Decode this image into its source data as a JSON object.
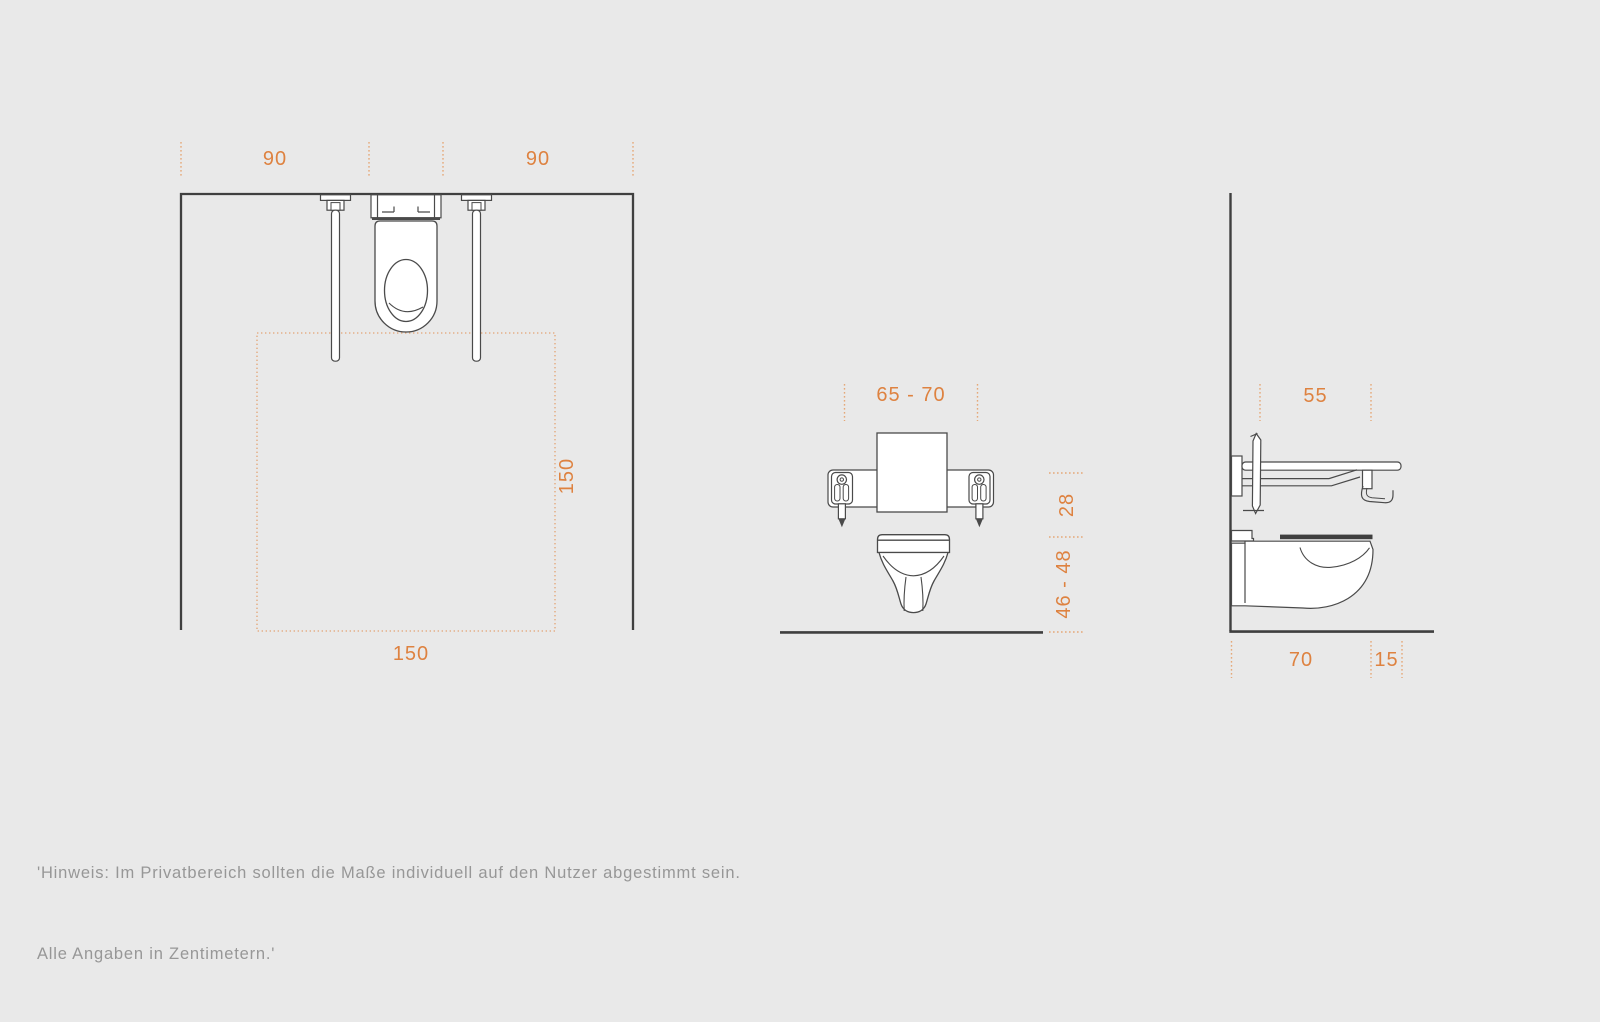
{
  "colors": {
    "background": "#e9e9e9",
    "fixture_line": "#4a4a4a",
    "wall_line": "#3f3f3f",
    "accent_orange": "#de8240",
    "tick_orange": "#e5a878",
    "note_gray": "#979797"
  },
  "views": {
    "plan": {
      "dim_left_clearance": "90",
      "dim_right_clearance": "90",
      "dim_maneuvering_depth": "150",
      "dim_maneuvering_width": "150"
    },
    "front": {
      "dim_grab_bar_span": "65 - 70",
      "dim_seat_to_bar_height": "28",
      "dim_seat_height": "46 - 48"
    },
    "side": {
      "dim_grab_bar_depth": "55",
      "dim_wc_depth": "70",
      "dim_bar_overhang": "15"
    }
  },
  "note": {
    "line1": "'Hinweis: Im Privatbereich sollten die Maße individuell auf den Nutzer abgestimmt sein.",
    "line2": "Alle Angaben in Zentimetern.'"
  }
}
